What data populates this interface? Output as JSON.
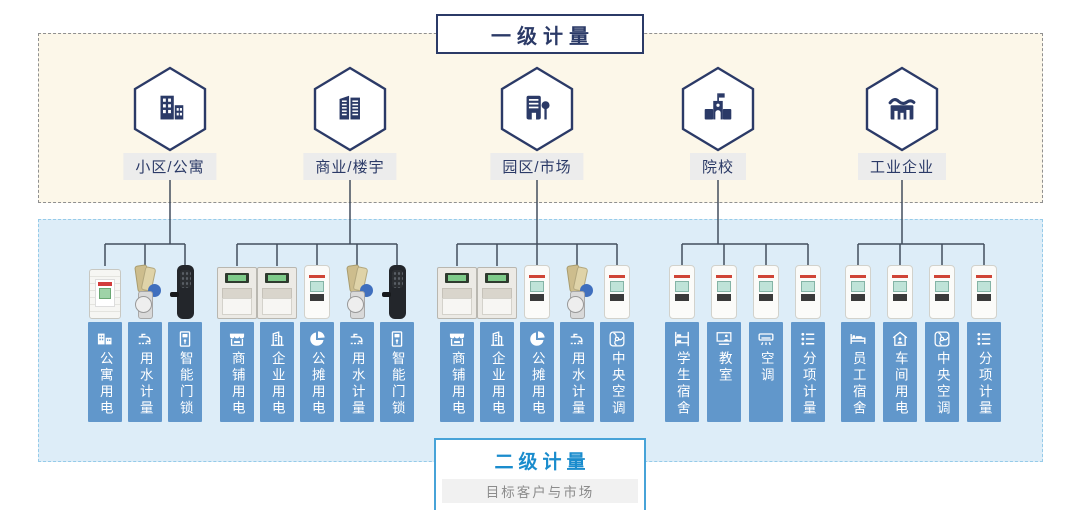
{
  "primary_section": {
    "title": "一级计量",
    "background": "#fcf7e9",
    "border_color": "#909090",
    "categories": [
      {
        "label": "小区/公寓",
        "icon": "residential-buildings"
      },
      {
        "label": "商业/楼宇",
        "icon": "commercial-towers"
      },
      {
        "label": "园区/市场",
        "icon": "campus-building-tree"
      },
      {
        "label": "院校",
        "icon": "school-building"
      },
      {
        "label": "工业企业",
        "icon": "factory-chart"
      }
    ]
  },
  "secondary_section": {
    "title": "二级计量",
    "subtitle": "目标客户与市场",
    "background": "#ddedf8",
    "border_color": "#96cbe9",
    "tag_color": "#6197cb",
    "groups": [
      {
        "category": "小区/公寓",
        "items": [
          {
            "label": "公寓用电",
            "icon": "apartment-power",
            "device": "din-energy-meter"
          },
          {
            "label": "用水计量",
            "icon": "water-tap",
            "device": "water-meter"
          },
          {
            "label": "智能门锁",
            "icon": "smart-lock",
            "device": "smart-lock"
          }
        ]
      },
      {
        "category": "商业/楼宇",
        "items": [
          {
            "label": "商铺用电",
            "icon": "shop-awning",
            "device": "three-phase-meter"
          },
          {
            "label": "企业用电",
            "icon": "enterprise-building",
            "device": "three-phase-meter"
          },
          {
            "label": "公摊用电",
            "icon": "pie-share",
            "device": "prepaid-card-meter"
          },
          {
            "label": "用水计量",
            "icon": "water-tap",
            "device": "water-meter"
          },
          {
            "label": "智能门锁",
            "icon": "smart-lock",
            "device": "smart-lock"
          }
        ]
      },
      {
        "category": "园区/市场",
        "items": [
          {
            "label": "商铺用电",
            "icon": "shop-awning",
            "device": "three-phase-meter"
          },
          {
            "label": "企业用电",
            "icon": "enterprise-building",
            "device": "three-phase-meter"
          },
          {
            "label": "公摊用电",
            "icon": "pie-share",
            "device": "prepaid-card-meter"
          },
          {
            "label": "用水计量",
            "icon": "water-tap",
            "device": "water-meter"
          },
          {
            "label": "中央空调",
            "icon": "fan",
            "device": "prepaid-card-meter"
          }
        ]
      },
      {
        "category": "院校",
        "items": [
          {
            "label": "学生宿舍",
            "icon": "bunk-bed",
            "device": "prepaid-card-meter"
          },
          {
            "label": "教室",
            "icon": "classroom-board",
            "device": "prepaid-card-meter"
          },
          {
            "label": "空调",
            "icon": "ac-unit",
            "device": "prepaid-card-meter"
          },
          {
            "label": "分项计量",
            "icon": "itemized-list",
            "device": "prepaid-card-meter"
          }
        ]
      },
      {
        "category": "工业企业",
        "items": [
          {
            "label": "员工宿舍",
            "icon": "bed",
            "device": "prepaid-card-meter"
          },
          {
            "label": "车间用电",
            "icon": "workshop-house",
            "device": "prepaid-card-meter"
          },
          {
            "label": "中央空调",
            "icon": "fan",
            "device": "prepaid-card-meter"
          },
          {
            "label": "分项计量",
            "icon": "itemized-list",
            "device": "prepaid-card-meter"
          }
        ]
      }
    ]
  },
  "colors": {
    "navy": "#2b3a67",
    "connector_line": "#434e5e",
    "secondary_title_blue": "#1a8ccd"
  }
}
